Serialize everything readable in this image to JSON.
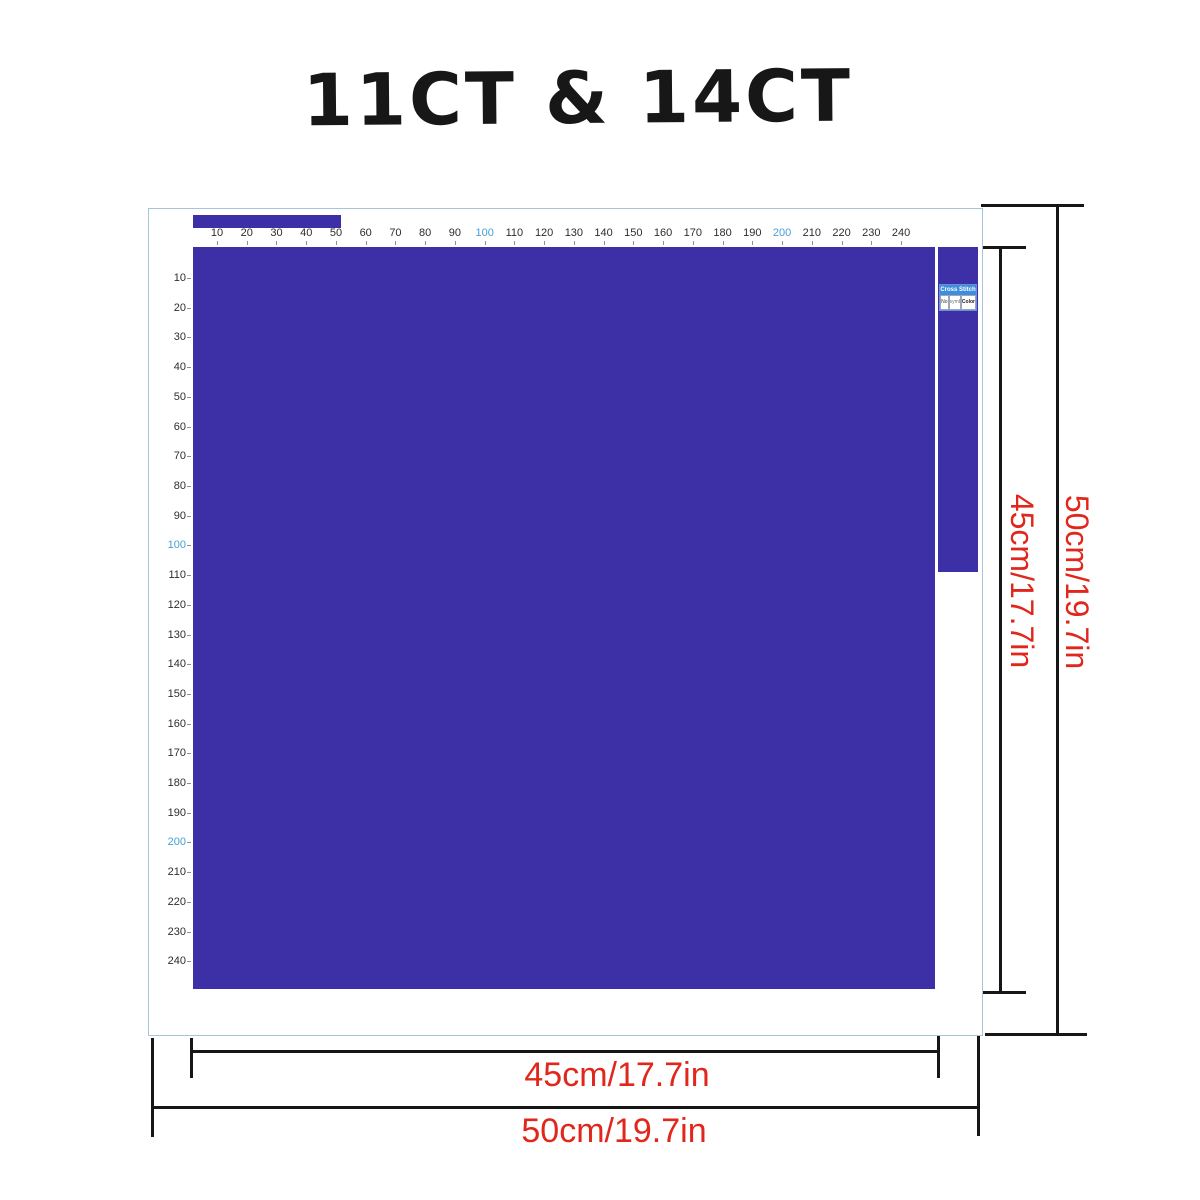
{
  "title": "11CT & 14CT",
  "colors": {
    "fabric_purple": "#3d2fa6",
    "ruler_highlight_blue": "#45a0d6",
    "ruler_number_dark": "#2d2d2d",
    "dimension_red": "#e1261c",
    "dimension_line_black": "#161616",
    "canvas_border_blue": "#a6c5d8",
    "legend_header_blue": "#3f8edd"
  },
  "rulers": {
    "top": {
      "numbers": [
        "10",
        "20",
        "30",
        "40",
        "50",
        "60",
        "70",
        "80",
        "90",
        "100",
        "110",
        "120",
        "130",
        "140",
        "150",
        "160",
        "170",
        "180",
        "190",
        "200",
        "210",
        "220",
        "230",
        "240"
      ],
      "highlighted": [
        "100",
        "200"
      ]
    },
    "left": {
      "numbers": [
        "10",
        "20",
        "30",
        "40",
        "50",
        "60",
        "70",
        "80",
        "90",
        "100",
        "110",
        "120",
        "130",
        "140",
        "150",
        "160",
        "170",
        "180",
        "190",
        "200",
        "210",
        "220",
        "230",
        "240"
      ],
      "highlighted": [
        "100",
        "200"
      ]
    }
  },
  "legend": {
    "header": "Cross Stitch",
    "columns": [
      "No",
      "symbol",
      "Color"
    ]
  },
  "dimensions": {
    "inner_width": "45cm/17.7in",
    "outer_width": "50cm/19.7in",
    "inner_height": "45cm/17.7in",
    "outer_height": "50cm/19.7in"
  }
}
